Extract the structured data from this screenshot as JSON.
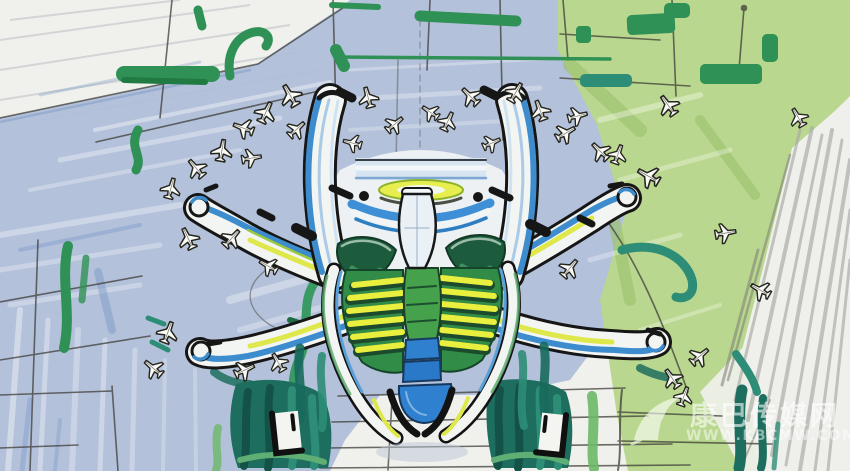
{
  "description": "Hand-drawn marker and watercolor concept sketch, aerial plan view of a starfish-shaped airport terminal with six curved concourse arms, a ribbed central hall, parked aircraft along the piers, blue-gray and green landscape washes, and perspective sketch grid lines",
  "watermark": {
    "site_name": "康巴传媒网",
    "url": "WWW.KBCMW.COM"
  },
  "icons": {
    "airplane": "airplane-icon",
    "watermark_logo": "watermark-logo-icon"
  },
  "palette": {
    "paper": "#f0f1ec",
    "wash_blue": "#aebdd8",
    "wash_blue_deep": "#7f9dc9",
    "wash_green": "#b9d78e",
    "marker_green": "#2f9155",
    "marker_teal": "#2e8d77",
    "marker_dark_teal": "#1d6e5e",
    "marker_blue": "#2f80cf",
    "marker_yellow": "#dfe84a",
    "ink": "#161616",
    "pencil": "#8b8b85",
    "watermark_white": "#ffffff"
  }
}
